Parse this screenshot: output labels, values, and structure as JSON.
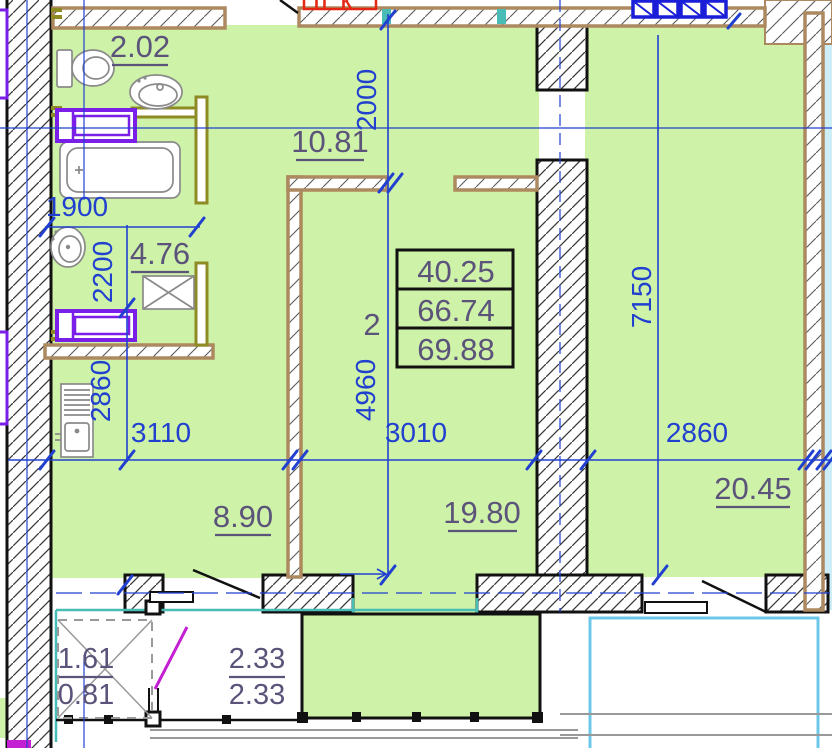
{
  "title": "apartment unit 2 floor plan",
  "colors": {
    "green": "#cdf2a8",
    "lcyan": "#cdeef6",
    "dim": "#2140d0",
    "label": "#5b5379",
    "brown": "#ad8960",
    "olive": "#8e8a24",
    "purple": "#7a1fe8",
    "teal": "#49bdb5",
    "cyan": "#6cc8e8",
    "red": "#e42613",
    "magenta": "#c41fd2",
    "wblue": "#1a1ed6",
    "gray": "#8a8a8a",
    "ink": "#111111"
  },
  "info": {
    "unit": "2",
    "living_area": "40.25",
    "apartment_area": "66.74",
    "total_area": "69.88"
  },
  "rooms": {
    "wc": "2.02",
    "hall": "10.81",
    "bath": "4.76",
    "kitchen": "8.90",
    "living": "19.80",
    "bedroom": "20.45"
  },
  "balconies": {
    "b1_upper": "1.61",
    "b1_lower": "0.81",
    "b2_upper": "2.33",
    "b2_lower": "2.33"
  },
  "dims": {
    "hall_w": "2000",
    "wc_w": "1900",
    "bath_h": "2200",
    "kitchen_h": "2860",
    "kitchen_w": "3110",
    "living_w": "3010",
    "bedroom_w": "2860",
    "living_h": "4960",
    "bedroom_h": "7150"
  },
  "stamp": {
    "label": "ПК"
  }
}
